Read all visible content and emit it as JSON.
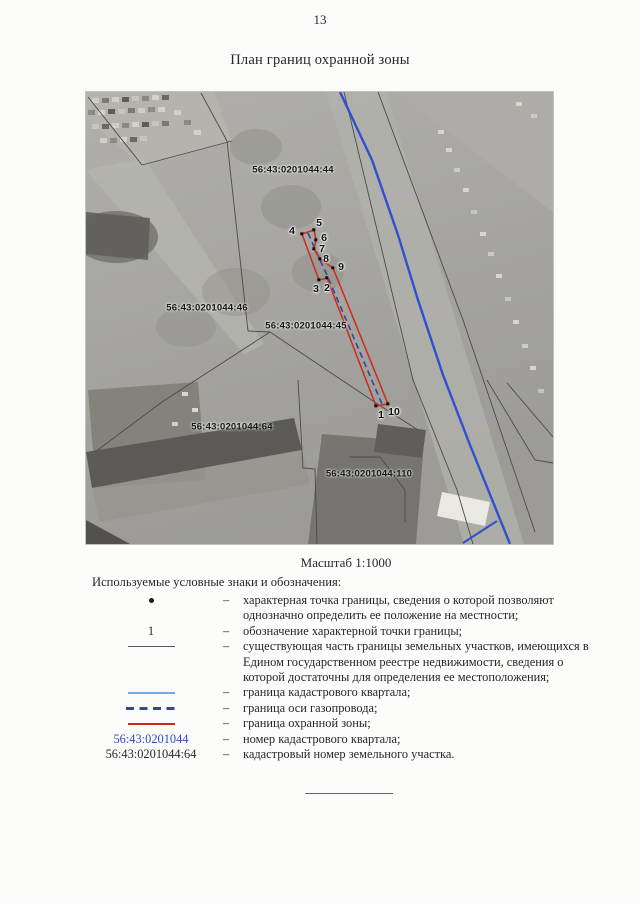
{
  "page": {
    "number": "13",
    "title": "План границ охранной зоны"
  },
  "map": {
    "scale_label": "Масштаб 1:1000",
    "parcel_labels": [
      {
        "text": "56:43:0201044:44",
        "x": 207,
        "y": 78
      },
      {
        "text": "56:43:0201044:46",
        "x": 121,
        "y": 216
      },
      {
        "text": "56:43:0201044:45",
        "x": 220,
        "y": 234
      },
      {
        "text": "56:43:0201044:64",
        "x": 146,
        "y": 335
      },
      {
        "text": "56:43:0201044:110",
        "x": 283,
        "y": 382
      }
    ],
    "points": [
      {
        "n": "1",
        "dot": [
          290,
          314
        ],
        "label": [
          295,
          323
        ]
      },
      {
        "n": "2",
        "dot": [
          241,
          186
        ],
        "label": [
          241,
          196
        ]
      },
      {
        "n": "3",
        "dot": [
          233,
          188
        ],
        "label": [
          230,
          197
        ]
      },
      {
        "n": "4",
        "dot": [
          216,
          142
        ],
        "label": [
          206,
          139
        ]
      },
      {
        "n": "5",
        "dot": [
          228,
          138
        ],
        "label": [
          233,
          131
        ]
      },
      {
        "n": "6",
        "dot": [
          230,
          148
        ],
        "label": [
          238,
          146
        ]
      },
      {
        "n": "7",
        "dot": [
          228,
          157
        ],
        "label": [
          236,
          157
        ]
      },
      {
        "n": "8",
        "dot": [
          234,
          167
        ],
        "label": [
          240,
          167
        ]
      },
      {
        "n": "9",
        "dot": [
          247,
          176
        ],
        "label": [
          255,
          175
        ]
      },
      {
        "n": "10",
        "dot": [
          302,
          312
        ],
        "label": [
          308,
          320
        ]
      }
    ]
  },
  "legend": {
    "heading": "Используемые условные знаки и обозначения:",
    "separator": "–",
    "rows": [
      {
        "symbol": "point-dot",
        "text": "характерная точка границы, сведения о которой позволяют однозначно определить ее положение на местности;"
      },
      {
        "symbol": "point-number",
        "symbol_text": "1",
        "text": "обозначение характерной точки границы;"
      },
      {
        "symbol": "existing-boundary-line",
        "text": "существующая часть границы земельных участков, имеющихся в Едином государственном реестре недвижимости, сведения о которой достаточны для определения ее местоположения;"
      },
      {
        "symbol": "quarter-boundary-line",
        "text": "граница кадастрового квартала;"
      },
      {
        "symbol": "pipeline-axis-line",
        "text": "граница оси газопровода;"
      },
      {
        "symbol": "protected-zone-line",
        "text": "граница охранной зоны;"
      },
      {
        "symbol": "quarter-number",
        "symbol_text": "56:43:0201044",
        "text": "номер кадастрового квартала;"
      },
      {
        "symbol": "parcel-number",
        "symbol_text": "56:43:0201044:64",
        "text": "кадастровый номер земельного участка."
      }
    ]
  },
  "colors": {
    "quarter_boundary_blue": "#2f51cf",
    "legend_quarter_blue": "#74a9e4",
    "pipeline_axis_navy": "#36459c",
    "protected_zone_red": "#cd2a1c",
    "quarter_number_blue": "#2a4cc4",
    "existing_boundary_gray": "#55565c"
  }
}
